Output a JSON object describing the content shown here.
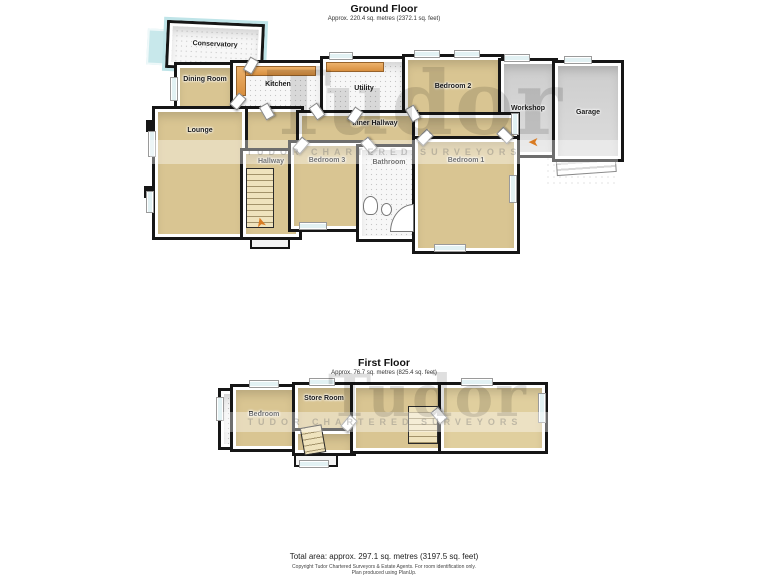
{
  "ground_floor": {
    "title": "Ground Floor",
    "subtitle": "Approx. 220.4 sq. metres (2372.1 sq. feet)",
    "rooms": {
      "conservatory": "Conservatory",
      "dining_room": "Dining Room",
      "kitchen": "Kitchen",
      "utility": "Utility",
      "bedroom_2": "Bedroom 2",
      "workshop": "Workshop",
      "garage": "Garage",
      "lounge": "Lounge",
      "hallway": "Hallway",
      "inner_hallway": "Inner Hallway",
      "bedroom_3": "Bedroom 3",
      "bathroom": "Bathroom",
      "bedroom_1": "Bedroom 1"
    }
  },
  "first_floor": {
    "title": "First Floor",
    "subtitle": "Approx. 76.7 sq. metres (825.4 sq. feet)",
    "rooms": {
      "bedroom": "Bedroom",
      "store_room": "Store Room"
    }
  },
  "watermark": {
    "brand": "Tudor",
    "band_text": "TUDOR CHARTERED SURVEYORS"
  },
  "footer": {
    "total_area": "Total area: approx. 297.1 sq. metres (3197.5 sq. feet)",
    "copyright": "Copyright Tudor Chartered Surveyors & Estate Agents. For room identification only.",
    "produced": "Plan produced using PlanUp."
  },
  "icons": {
    "entrance_arrow": "➤"
  },
  "colors": {
    "wall": "#161616",
    "carpet": "#d9c592",
    "tile": "#f7f7f7",
    "concrete": "#d6d6d6",
    "counter": "#dd9445",
    "glass": "#bfe4e8",
    "arrow": "#d97b22",
    "watermark_gray": "#d8d8d8"
  }
}
